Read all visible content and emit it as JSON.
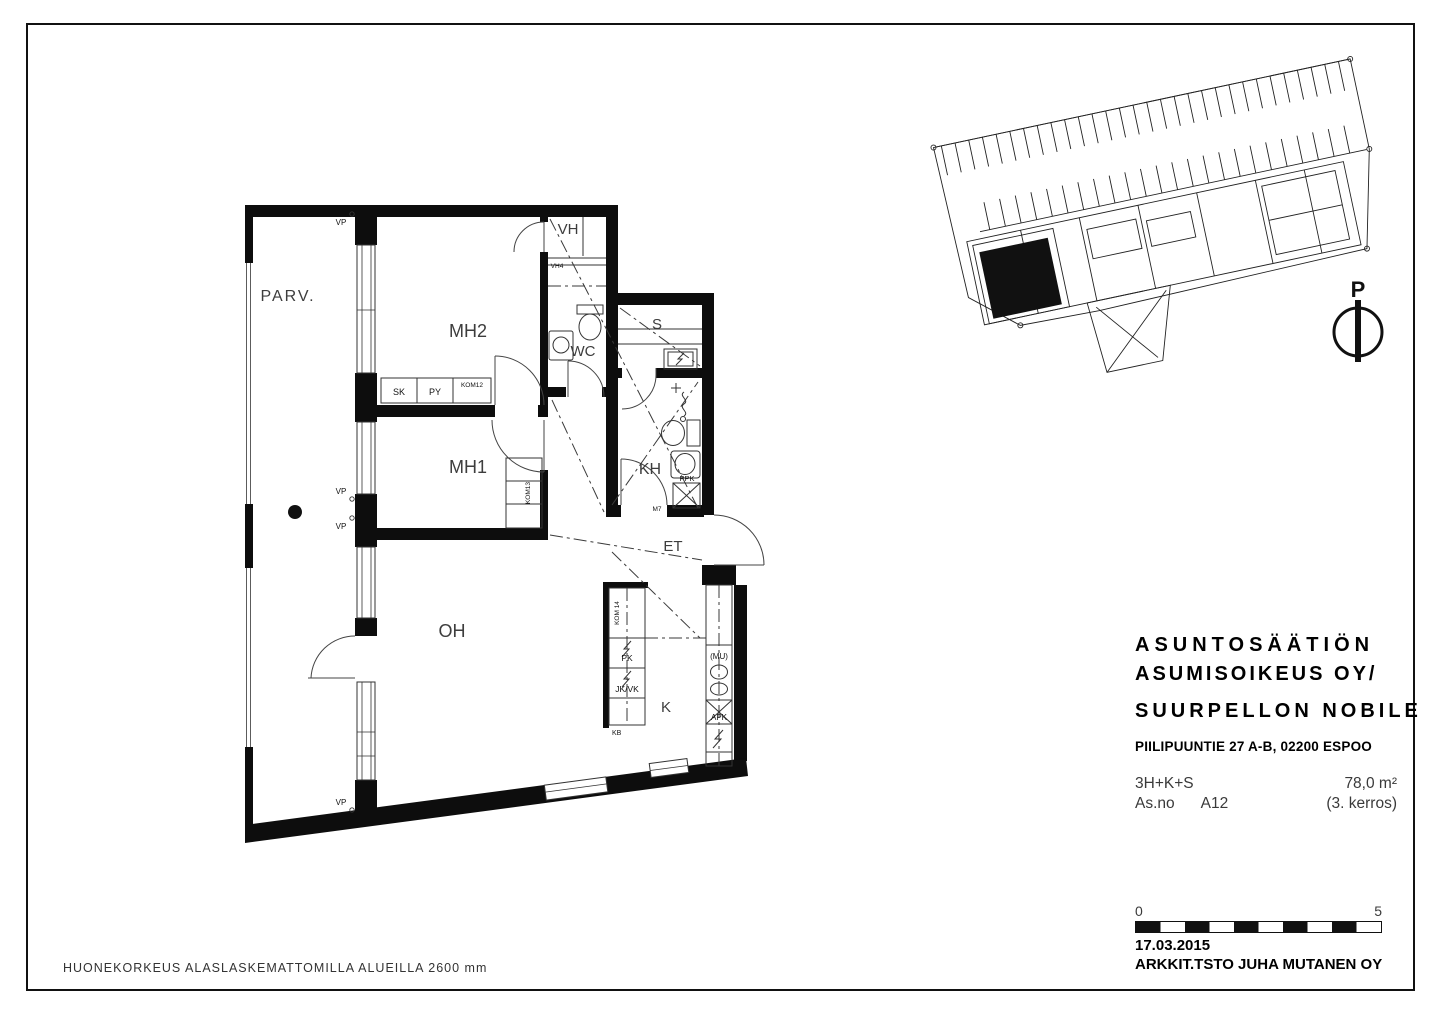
{
  "page": {
    "footer_note": "HUONEKORKEUS ALASLASKEMATTOMILLA ALUEILLA 2600 mm"
  },
  "title_block": {
    "company_line1": "ASUNTOSÄÄTIÖN",
    "company_line2": "ASUMISOIKEUS OY/",
    "project": "SUURPELLON NOBILE",
    "address": "PIILIPUUNTIE 27 A-B, 02200 ESPOO",
    "apartment_type": "3H+K+S",
    "area": "78,0 m²",
    "apartment_no_label": "As.no",
    "apartment_no": "A12",
    "floor": "(3. kerros)"
  },
  "stamp": {
    "date": "17.03.2015",
    "architect": "ARKKIT.TSTO JUHA MUTANEN OY"
  },
  "scale_bar": {
    "start_label": "0",
    "end_label": "5"
  },
  "north_arrow": {
    "label": "P"
  },
  "floor_plan": {
    "rooms": {
      "parv": "PARV.",
      "mh2": "MH2",
      "mh1": "MH1",
      "oh": "OH",
      "vh": "VH",
      "wc": "WC",
      "s": "S",
      "kh": "KH",
      "et": "ET",
      "k": "K"
    },
    "labels": {
      "vh4": "VH4",
      "vp": "VP",
      "sk": "SK",
      "py": "PY",
      "kom12": "KOM12",
      "kom13": "KOM13",
      "kom14": "KOM 14",
      "pk": "PK",
      "jkvk": "JK/VK",
      "kb": "KB",
      "mu": "(MU)",
      "apk": "APK",
      "ppk": "PPK",
      "m7": "M7"
    }
  }
}
